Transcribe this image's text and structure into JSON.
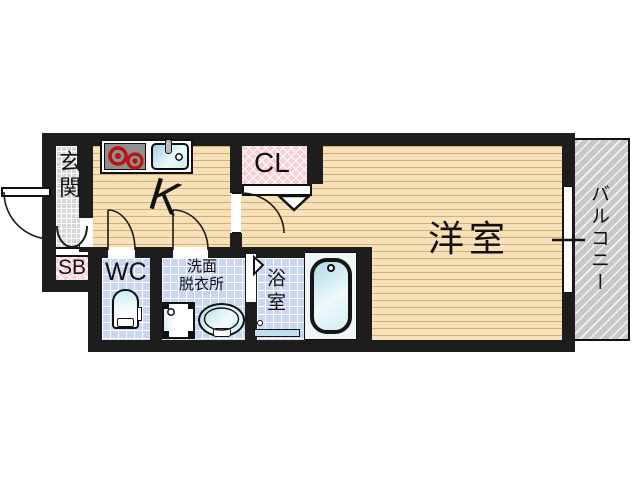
{
  "floorplan": {
    "rooms": {
      "genkan": {
        "label": "玄関"
      },
      "shoe_box": {
        "label": "SB"
      },
      "kitchen": {
        "label": "K"
      },
      "closet": {
        "label": "CL"
      },
      "western_room": {
        "label": "洋室"
      },
      "balcony": {
        "label": "バルコニー"
      },
      "toilet": {
        "label": "WC"
      },
      "washroom": {
        "label_line1": "洗面",
        "label_line2": "脱衣所"
      },
      "bathroom": {
        "label": "浴室"
      }
    },
    "colors": {
      "wall": "#1d1d1d",
      "wood_floor": "#f6e1b8",
      "wet_tile": "#c9d6f1",
      "entry_tile": "#d7d7d7",
      "closet_pink": "#f7cfd5",
      "balcony_gray": "#c8c8c8",
      "fixture_cyan": "#bfe4ea",
      "burner_red": "#bb1111"
    }
  }
}
